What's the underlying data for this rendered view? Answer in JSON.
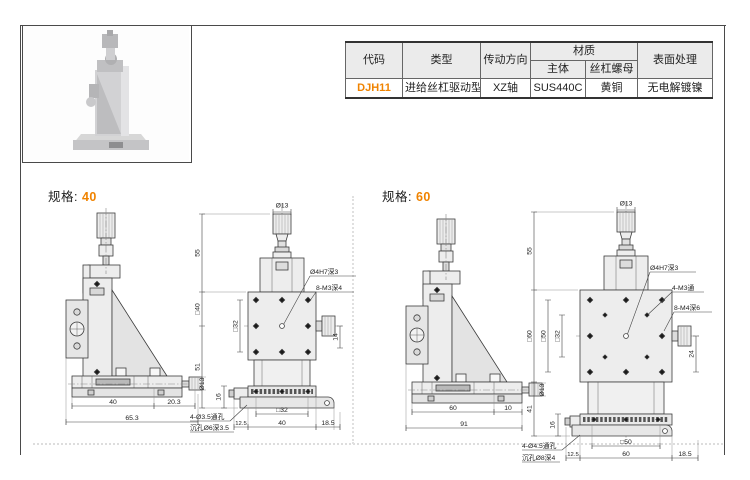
{
  "accent_color": "#f08300",
  "table": {
    "h_code": "代码",
    "h_type": "类型",
    "h_direction": "传动方向",
    "h_material": "材质",
    "h_material_body": "主体",
    "h_material_nut": "丝杠螺母",
    "h_surface": "表面处理",
    "r_code": "DJH11",
    "r_type": "进给丝杠驱动型",
    "r_direction": "XZ轴",
    "r_material_body": "SUS440C",
    "r_material_nut": "黄铜",
    "r_surface": "无电解镀镍"
  },
  "spec40": {
    "title": "规格:",
    "size": "40",
    "side": {
      "dia": "Ø13",
      "base": "40",
      "step": "20.3",
      "total": "65.3"
    },
    "front": {
      "dia": "Ø13",
      "top": "55",
      "plate": "□40",
      "lower": "51",
      "rail": "16",
      "grid": "□32",
      "offset": "14",
      "center_hole": "Ø4H7深3",
      "corner_holes": "8-M3深4",
      "note1": "4-Ø3.5通孔",
      "note2": "沉孔Ø6深3.5",
      "b_left": "12.5",
      "b_grid": "□32",
      "b_mid": "40",
      "b_right": "18.5"
    }
  },
  "spec60": {
    "title": "规格:",
    "size": "60",
    "side": {
      "dia": "Ø13",
      "base": "60",
      "step": "10",
      "total": "91"
    },
    "front": {
      "dia": "Ø13",
      "top": "55",
      "plate": "□60",
      "mid": "□50",
      "grid": "□32",
      "lower": "41",
      "rail": "16",
      "offset": "24",
      "center_hole": "Ø4H7深3",
      "through_holes": "4-M3通",
      "corner_holes": "8-M4深6",
      "note1": "4-Ø4.5通孔",
      "note2": "沉孔Ø8深4",
      "b_left": "12.5",
      "b_grid": "□50",
      "b_mid": "60",
      "b_right": "18.5"
    }
  }
}
